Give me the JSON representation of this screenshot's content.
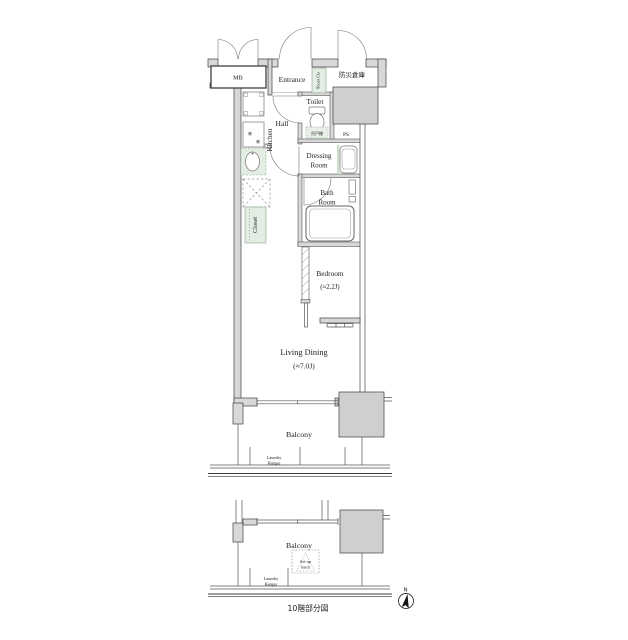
{
  "colors": {
    "wall_fill": "#d8d8d8",
    "wall_stroke": "#3f3f3f",
    "shaft_fill": "#cdd0cc",
    "closet_fill": "#e3ede3",
    "closet_stroke": "#8aa58a",
    "line": "#666666",
    "text": "#222222"
  },
  "upper_plan": {
    "mb": "MB",
    "entrance": "Entrance",
    "storage": "防災倉庫",
    "shoes_closet": "Shoes Cls",
    "toilet": "Toilet",
    "hall": "Hall",
    "kitchen": "Kitchen",
    "ps": "PS",
    "dressing_line1": "Dressing",
    "dressing_line2": "Room",
    "bath_line1": "Bath",
    "bath_line2": "Room",
    "cabinet": "吊戸棚",
    "closet": "Closet",
    "bedroom": "Bedroom",
    "bedroom_size": "(≈2.2J)",
    "living": "Living Dining",
    "living_size": "(≈7.0J)",
    "balcony": "Balcony",
    "laundry_line1": "Laundry",
    "laundry_line2": "Hanger"
  },
  "lower_plan": {
    "balcony": "Balcony",
    "hatch_line1": "Set-up",
    "hatch_line2": "hatch",
    "laundry_line1": "Laundry",
    "laundry_line2": "Hanger",
    "caption": "10階部分図"
  },
  "compass": {
    "north": "N"
  },
  "icons": {
    "burner": "✳"
  }
}
